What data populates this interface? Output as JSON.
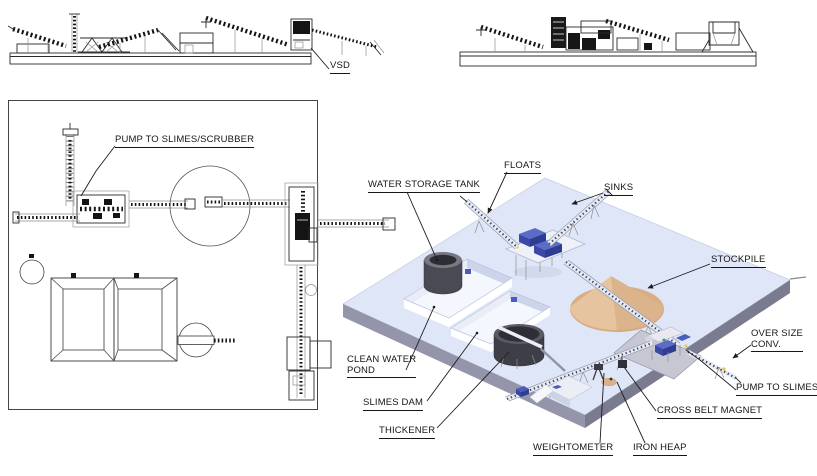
{
  "elevation_left": {
    "label_vsd": "VSD"
  },
  "plan_view": {
    "label_pump_scrubber": "PUMP TO SLIMES/SCRUBBER"
  },
  "iso_view": {
    "label_water_storage_tank": "WATER STORAGE TANK",
    "label_floats": "FLOATS",
    "label_sinks": "SINKS",
    "label_stockpile": "STOCKPILE",
    "label_over_size_line1": "OVER SIZE",
    "label_over_size_line2": "CONV.",
    "label_pump_to_slimes": "PUMP TO SLIMES",
    "label_cross_belt_magnet": "CROSS BELT MAGNET",
    "label_weightometer": "WEIGHTOMETER",
    "label_iron_heap": "IRON HEAP",
    "label_clean_water_line1": "CLEAN WATER",
    "label_clean_water_line2": "POND",
    "label_slimes_dam": "SLIMES DAM",
    "label_thickener": "THICKENER"
  },
  "colors": {
    "platform_top": "#dfe6f7",
    "platform_side_left": "#9494aa",
    "platform_side_right": "#7b7b90",
    "stockpile_base": "#d8ae83",
    "stockpile_light": "#e6c4a0",
    "stockpile_shade": "#d2a87b",
    "tank_body": "#4a4a54",
    "tank_top": "#787882",
    "equipment_blue": "#4c5cbd",
    "equipment_blue_dark": "#2e3c92",
    "pad_gray": "#c7c7d3",
    "line_dark": "#141414"
  }
}
